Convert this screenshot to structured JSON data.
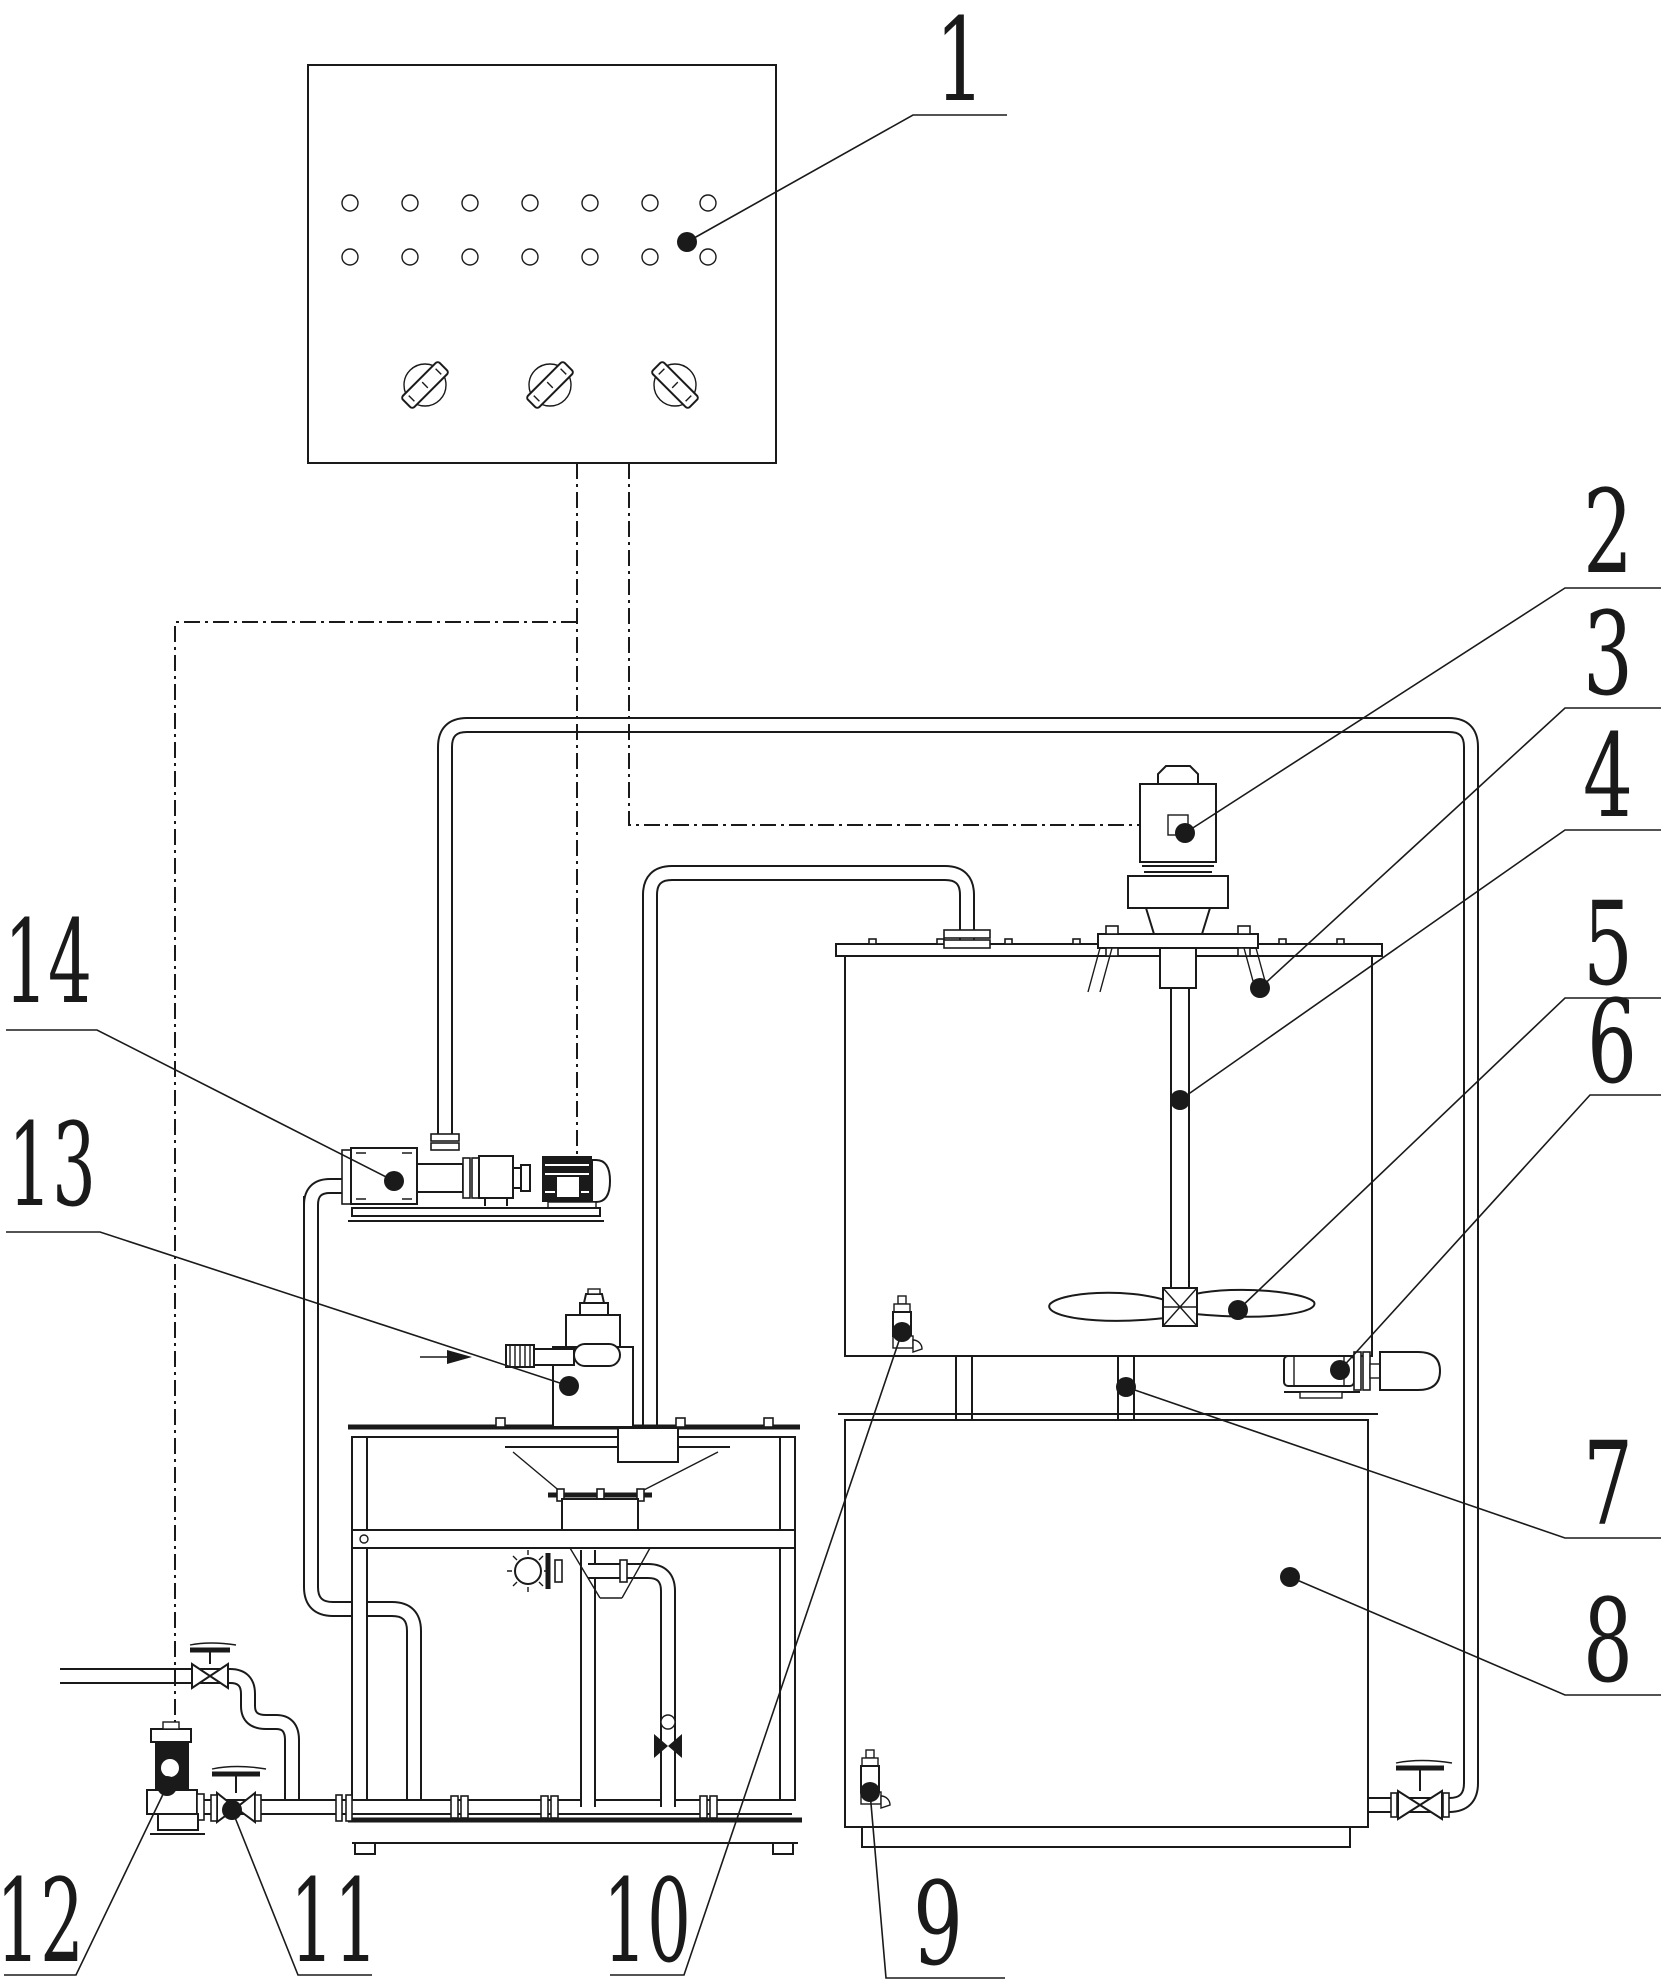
{
  "figure": {
    "width": 1661,
    "height": 1988,
    "background_color": "#ffffff",
    "line_color": "#1a1a1a",
    "callout_font_size": 115
  },
  "control_panel": {
    "indicator_light_rows": 2,
    "indicator_light_columns": 7,
    "rotary_switch_count": 3
  },
  "callouts": [
    {
      "label": "1",
      "text": [
        960,
        100
      ],
      "attach": [
        913,
        115
      ],
      "underline_to": 1007,
      "dot": [
        687,
        242
      ]
    },
    {
      "label": "2",
      "text": [
        1608,
        572
      ],
      "attach": [
        1565,
        588
      ],
      "underline_to": 1661,
      "dot": [
        1185,
        833
      ]
    },
    {
      "label": "3",
      "text": [
        1608,
        694
      ],
      "attach": [
        1565,
        708
      ],
      "underline_to": 1661,
      "dot": [
        1260,
        988
      ]
    },
    {
      "label": "4",
      "text": [
        1608,
        816
      ],
      "attach": [
        1565,
        830
      ],
      "underline_to": 1661,
      "dot": [
        1180,
        1100
      ]
    },
    {
      "label": "5",
      "text": [
        1608,
        984
      ],
      "attach": [
        1565,
        998
      ],
      "underline_to": 1661,
      "dot": [
        1238,
        1310
      ]
    },
    {
      "label": "6",
      "text": [
        1612,
        1082
      ],
      "attach": [
        1590,
        1095
      ],
      "underline_to": 1661,
      "dot": [
        1340,
        1370
      ]
    },
    {
      "label": "7",
      "text": [
        1608,
        1524
      ],
      "attach": [
        1565,
        1538
      ],
      "underline_to": 1661,
      "dot": [
        1126,
        1387
      ]
    },
    {
      "label": "8",
      "text": [
        1608,
        1681
      ],
      "attach": [
        1565,
        1695
      ],
      "underline_to": 1661,
      "dot": [
        1290,
        1577
      ]
    },
    {
      "label": "9",
      "text": [
        938,
        1964
      ],
      "attach": [
        886,
        1978
      ],
      "underline_to": 1005,
      "dot": [
        870,
        1792
      ]
    },
    {
      "label": "10",
      "text": [
        647,
        1961
      ],
      "attach": [
        684,
        1975
      ],
      "underline_to": 610,
      "dot": [
        902,
        1332
      ]
    },
    {
      "label": "11",
      "text": [
        334,
        1961
      ],
      "attach": [
        298,
        1975
      ],
      "underline_to": 372,
      "dot": [
        232,
        1810
      ]
    },
    {
      "label": "12",
      "text": [
        40,
        1961
      ],
      "attach": [
        76,
        1975
      ],
      "underline_to": 4,
      "dot": [
        167,
        1786
      ]
    },
    {
      "label": "13",
      "text": [
        52,
        1205
      ],
      "attach": [
        100,
        1232
      ],
      "underline_to": 6,
      "dot": [
        569,
        1386
      ]
    },
    {
      "label": "14",
      "text": [
        48,
        1002
      ],
      "attach": [
        97,
        1030
      ],
      "underline_to": 6,
      "dot": [
        394,
        1181
      ]
    }
  ]
}
